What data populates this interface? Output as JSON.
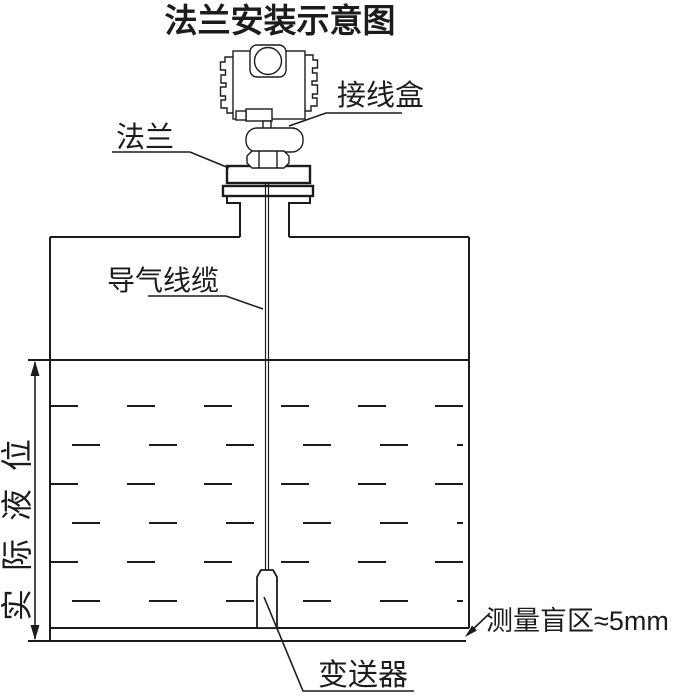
{
  "title": "法兰安装示意图",
  "labels": {
    "junction_box": "接线盒",
    "flange": "法兰",
    "air_cable": "导气线缆",
    "actual_level": "实际液位",
    "blind_zone": "测量盲区≈5mm",
    "transmitter": "变送器"
  },
  "colors": {
    "line": "#1c1c1c",
    "background": "#ffffff"
  }
}
